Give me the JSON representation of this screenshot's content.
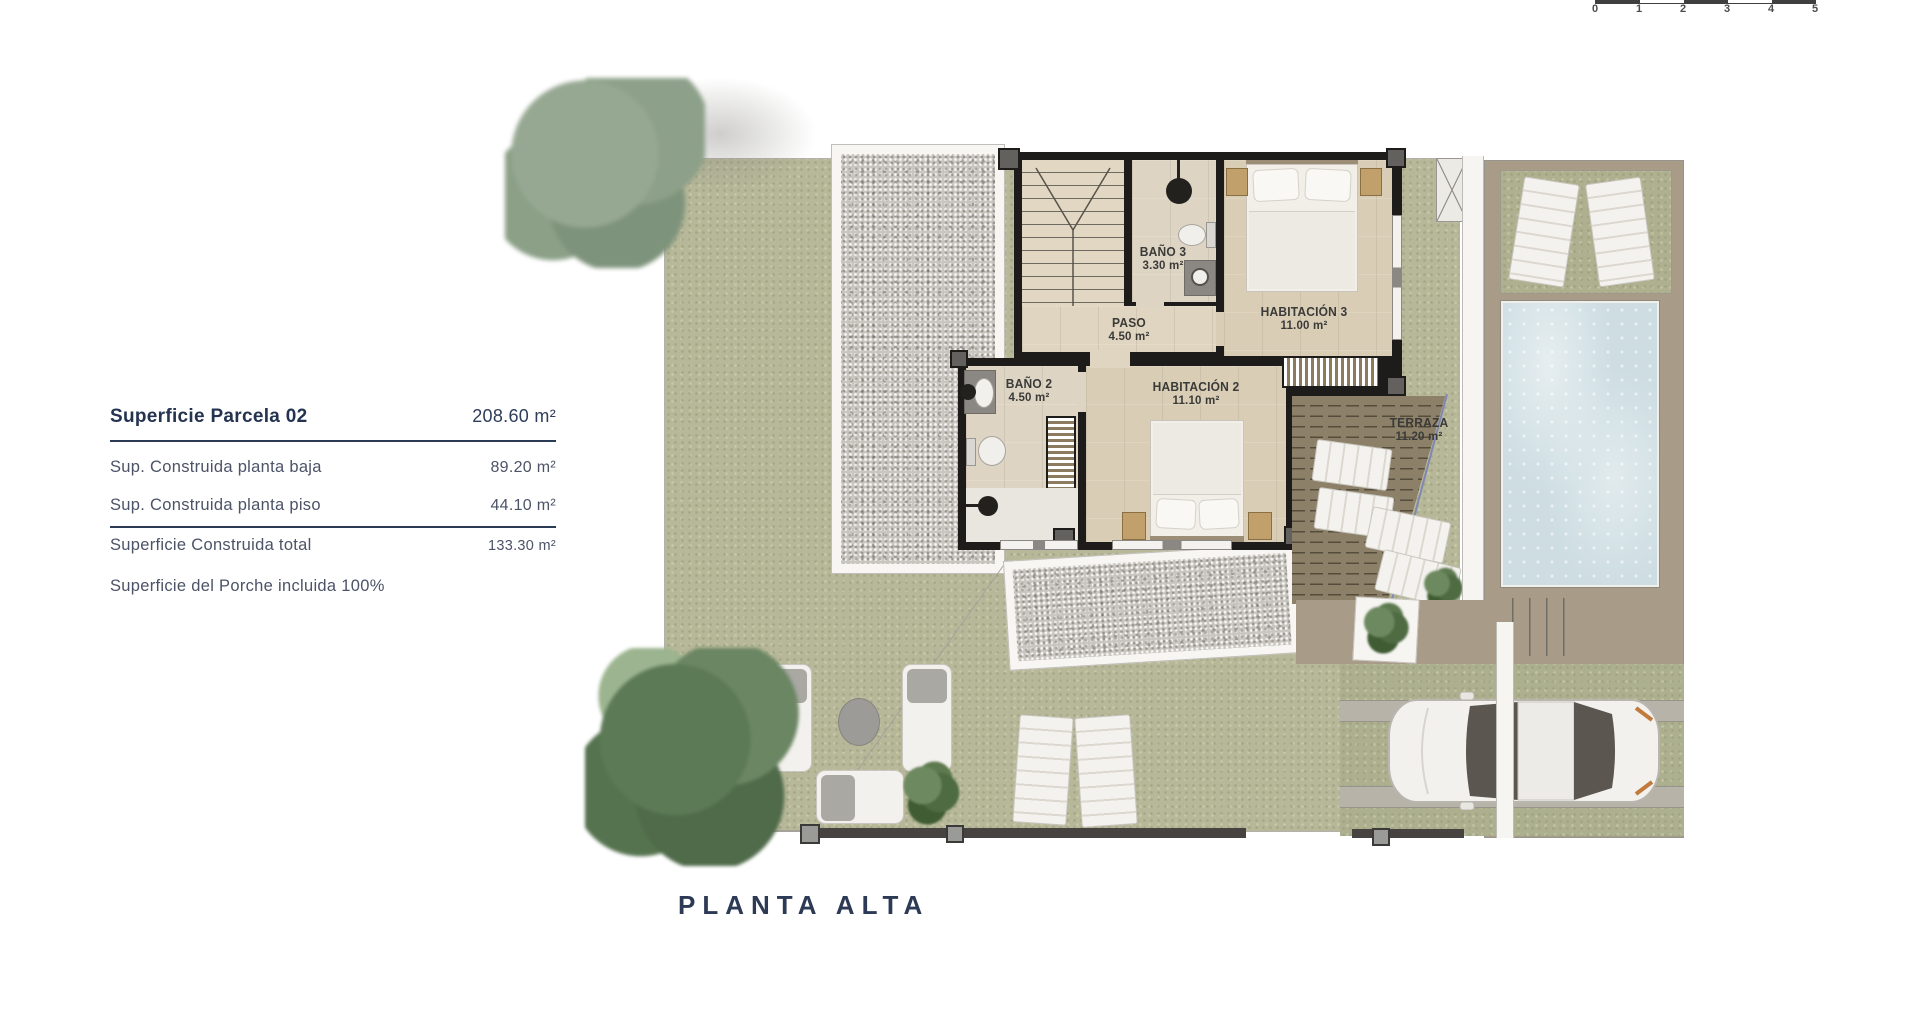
{
  "scale_bar": {
    "ticks": [
      "0",
      "1",
      "2",
      "3",
      "4",
      "5"
    ]
  },
  "info_panel": {
    "row1": {
      "label": "Superficie Parcela 02",
      "value": "208.60 m²"
    },
    "row2": {
      "label": "Sup. Construida planta baja",
      "value": "89.20 m²"
    },
    "row3": {
      "label": "Sup. Construida planta piso",
      "value": "44.10 m²"
    },
    "row4": {
      "label": "Superficie Construida total",
      "value": "133.30 m²"
    },
    "row5": {
      "label": "Superficie del Porche incluida 100%"
    }
  },
  "plan": {
    "title": "PLANTA ALTA",
    "rooms": {
      "bano3": {
        "name": "BAÑO 3",
        "area": "3.30 m²"
      },
      "paso": {
        "name": "PASO",
        "area": "4.50 m²"
      },
      "habitacion3": {
        "name": "HABITACIÓN 3",
        "area": "11.00 m²"
      },
      "bano2": {
        "name": "BAÑO 2",
        "area": "4.50 m²"
      },
      "habitacion2": {
        "name": "HABITACIÓN 2",
        "area": "11.10 m²"
      },
      "terraza": {
        "name": "TERRAZA",
        "area": "11.20 m²"
      }
    }
  },
  "colors": {
    "accent_navy": "#2d3a55",
    "plan_label_text": "#3a3a38",
    "grass": "#b6b899",
    "gravel": "#c9c6c0",
    "wall": "#1d1c1a",
    "floor": "#d9cdb6",
    "pool_water": "#cddde2",
    "deck": "#a89c89",
    "pergola": "#8d8068"
  }
}
